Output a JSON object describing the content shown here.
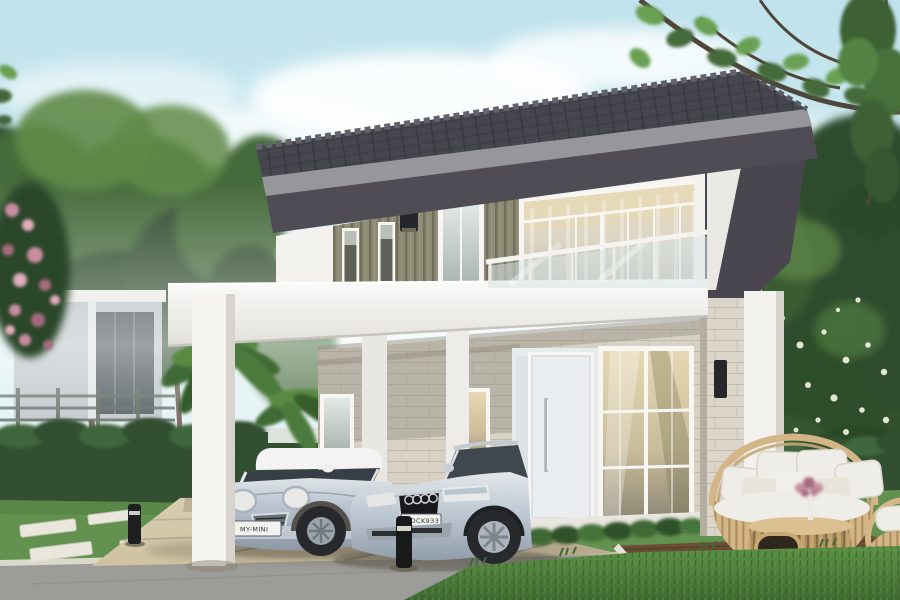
{
  "scene": {
    "type": "architectural-photo-render",
    "subject": "Modern two-storey house with tiled hip roof, glass balcony, carport with two silver cars, landscaped garden and rattan patio set",
    "objects": [
      "sky",
      "clouds",
      "trees",
      "neighbor-house",
      "pink-flower-bush",
      "tropical-plants",
      "hedge",
      "lawn",
      "stepping-stones",
      "driveway",
      "street",
      "house",
      "tiled-roof",
      "slat-cladding",
      "balcony-glass-railing",
      "upper-window",
      "front-door",
      "ground-window",
      "wall-lamps",
      "carport",
      "white-columns",
      "mini-cooper",
      "audi-sedan",
      "bollard-lights",
      "wooden-deck",
      "rattan-sofa",
      "rattan-coffee-table",
      "rattan-side-chair",
      "flower-vase"
    ]
  },
  "vehicles": {
    "mini": {
      "name": "mini-cooper",
      "plate": "MY-MINI"
    },
    "audi": {
      "name": "audi-sedan",
      "plate": "OOCK933"
    }
  },
  "colors": {
    "sky_top": "#bfe2ec",
    "sky_low": "#eaf6f6",
    "cloud": "#ffffff",
    "tree_dark": "#2f4c2d",
    "tree_mid": "#456a3b",
    "tree_light": "#5f8a49",
    "leaf_bright": "#69a052",
    "branch": "#4f463a",
    "hedge": "#324f31",
    "hedge_light": "#41663c",
    "lawn": "#63914f",
    "lawn_dark": "#49753c",
    "roof": "#45464e",
    "roof_edge": "#97969a",
    "soffit": "#4f4c55",
    "gable": "#494650",
    "wall_white": "#f3f2ef",
    "wall_shade": "#dddbd6",
    "slat": "#8e8b75",
    "slat_dark": "#6e6b57",
    "stone": "#d8d2c6",
    "stone_line": "#b8b1a2",
    "frame": "#f7f6f3",
    "glass_warm": "#e6dcbf",
    "glass_deep": "#8f8a76",
    "glass_cool": "#cfd8d6",
    "balcony_glass": "#d6e4e6",
    "door": "#eaedef",
    "dark_fixture": "#26272a",
    "drive": "#d9cdb0",
    "drive_shadow": "#b3a88d",
    "drive_line": "#8f8876",
    "street": "#9c9c98",
    "curb": "#e5e2d8",
    "pad": "#e9e6db",
    "deck": "#59422f",
    "deck_dark": "#46342a",
    "deck_border": "#e7e3d8",
    "rattan": "#d3b586",
    "rattan_dark": "#ac8c5e",
    "cushion": "#efede7",
    "cushion_shade": "#d9d5ca",
    "flower_pink": "#c98da0",
    "flower_deep": "#a66a7c",
    "car_mini": "#b4bfcb",
    "car_audi": "#bcc6d0",
    "car_glass": "#373e46",
    "tire": "#28292c",
    "plate": "#f2f3ee",
    "neighbor": "#b6bec2"
  }
}
